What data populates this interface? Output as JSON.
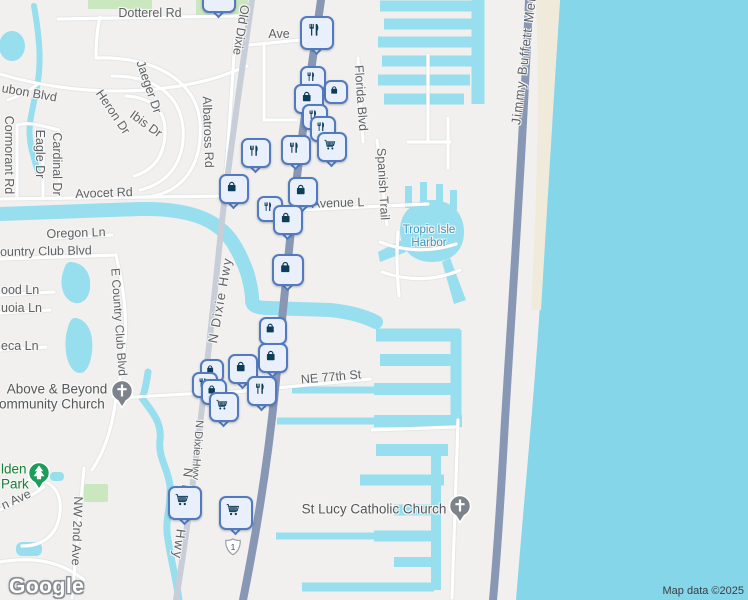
{
  "map": {
    "attribution": {
      "logo": "Google",
      "map_data": "Map data ©2025"
    },
    "route_shield": {
      "number": "1",
      "x": 233,
      "y": 547
    },
    "colors": {
      "land": "#F1F0EE",
      "ocean": "#86D6E9",
      "canal": "#97DEEE",
      "beach": "#F0EADB",
      "park_green": "#CBE7C0",
      "road_major": "#8797B4",
      "road_gray": "#C8CED7",
      "marker_bg": "#EAF0FB",
      "marker_border": "#5379BE",
      "marker_icon": "#0E3D58",
      "poi_church": "#7C838A",
      "poi_park": "#1E9C5A",
      "harbor_text": "#3E97BD",
      "park_text": "#188038"
    },
    "road_labels": [
      {
        "t": "Dotterel Rd",
        "x": 150,
        "y": 13,
        "r": 0
      },
      {
        "t": "Ave",
        "x": 279,
        "y": 34,
        "r": 0
      },
      {
        "t": "Old Dixie",
        "x": 241,
        "y": 30,
        "r": 99
      },
      {
        "t": "Albatross Rd",
        "x": 208,
        "y": 132,
        "r": 88
      },
      {
        "t": "Florida Blvd",
        "x": 361,
        "y": 98,
        "r": 86
      },
      {
        "t": "Jimmy Buffett Mem",
        "x": 524,
        "y": 57,
        "r": -83,
        "fs": 13,
        "ls": 1.5
      },
      {
        "t": "Spanish Trail",
        "x": 383,
        "y": 184,
        "r": 87
      },
      {
        "t": "Cormorant Rd",
        "x": 9,
        "y": 155,
        "r": 90
      },
      {
        "t": "Eagle Dr",
        "x": 40,
        "y": 154,
        "r": 90
      },
      {
        "t": "Cardinal Dr",
        "x": 57,
        "y": 164,
        "r": 90
      },
      {
        "t": "Heron Dr",
        "x": 113,
        "y": 112,
        "r": 56
      },
      {
        "t": "Ibis Dr",
        "x": 146,
        "y": 124,
        "r": 36
      },
      {
        "t": "Jaeger Dr",
        "x": 149,
        "y": 87,
        "r": 71
      },
      {
        "t": "Avocet Rd",
        "x": 104,
        "y": 193,
        "r": -2
      },
      {
        "t": "ubon Blvd",
        "x": 2,
        "y": 88,
        "r": 10,
        "a": "l"
      },
      {
        "t": "Oregon Ln",
        "x": 76,
        "y": 233,
        "r": -2
      },
      {
        "t": "ountry Club Blvd",
        "x": 0,
        "y": 252,
        "r": -1,
        "a": "l"
      },
      {
        "t": "ood Ln",
        "x": 1,
        "y": 290,
        "r": 0,
        "a": "l"
      },
      {
        "t": "uoia Ln",
        "x": 1,
        "y": 308,
        "r": 0,
        "a": "l"
      },
      {
        "t": "eca Ln",
        "x": 1,
        "y": 346,
        "r": 0,
        "a": "l"
      },
      {
        "t": "E Country Club Blvd",
        "x": 119,
        "y": 322,
        "r": 86,
        "fs": 12
      },
      {
        "t": "N Dixie Hwy",
        "x": 220,
        "y": 300,
        "r": -80,
        "fs": 13,
        "ls": 1.5
      },
      {
        "t": "N Dixie Hwy",
        "x": 197,
        "y": 450,
        "r": 94,
        "fs": 11
      },
      {
        "t": "N Dixie Hwy",
        "x": 183,
        "y": 514,
        "r": 97,
        "fs": 13,
        "ls": 2
      },
      {
        "t": "NE 77th St",
        "x": 331,
        "y": 377,
        "r": -5
      },
      {
        "t": "Avenue L",
        "x": 338,
        "y": 203,
        "r": -2
      },
      {
        "t": "NW 2nd Ave",
        "x": 77,
        "y": 531,
        "r": 92
      },
      {
        "t": "n Ave",
        "x": 2,
        "y": 506,
        "r": -25,
        "a": "l"
      }
    ],
    "poi_labels": [
      {
        "t": "Above & Beyond",
        "x": 57,
        "y": 389,
        "r": 0,
        "fs": 13.5,
        "c": "#54585C"
      },
      {
        "t": "Community Church",
        "x": 47,
        "y": 404,
        "r": 0,
        "fs": 13.5,
        "c": "#54585C"
      },
      {
        "t": "St Lucy Catholic Church",
        "x": 374,
        "y": 509,
        "r": 0,
        "fs": 13.5,
        "c": "#54585C"
      },
      {
        "t": "Tropic Isle",
        "x": 429,
        "y": 230,
        "r": 0,
        "fs": 11.5,
        "c": "#3E97BD"
      },
      {
        "t": "Harbor",
        "x": 429,
        "y": 243,
        "r": 0,
        "fs": 11.5,
        "c": "#3E97BD"
      },
      {
        "t": "lden",
        "x": 1,
        "y": 469,
        "r": 0,
        "fs": 13.5,
        "c": "#188038",
        "a": "l"
      },
      {
        "t": "Park",
        "x": 1,
        "y": 484,
        "r": 0,
        "fs": 13.5,
        "c": "#188038",
        "a": "l"
      }
    ],
    "markers": [
      {
        "type": "restaurant",
        "x": 219,
        "y": -4,
        "s": 34,
        "tail": true
      },
      {
        "type": "restaurant",
        "x": 317,
        "y": 33,
        "s": 34,
        "tail": true
      },
      {
        "type": "restaurant",
        "x": 313,
        "y": 79,
        "s": 26,
        "tail": true
      },
      {
        "type": "bag",
        "x": 336,
        "y": 92,
        "s": 24,
        "tail": false
      },
      {
        "type": "bag",
        "x": 309,
        "y": 99,
        "s": 30,
        "tail": true
      },
      {
        "type": "restaurant",
        "x": 315,
        "y": 117,
        "s": 26,
        "tail": false
      },
      {
        "type": "restaurant",
        "x": 323,
        "y": 129,
        "s": 26,
        "tail": false
      },
      {
        "type": "cart",
        "x": 332,
        "y": 147,
        "s": 30,
        "tail": true
      },
      {
        "type": "restaurant",
        "x": 256,
        "y": 153,
        "s": 30,
        "tail": true
      },
      {
        "type": "restaurant",
        "x": 296,
        "y": 150,
        "s": 30,
        "tail": true
      },
      {
        "type": "bag",
        "x": 234,
        "y": 189,
        "s": 30,
        "tail": true
      },
      {
        "type": "bag",
        "x": 303,
        "y": 192,
        "s": 30,
        "tail": true
      },
      {
        "type": "restaurant",
        "x": 270,
        "y": 209,
        "s": 26,
        "tail": false
      },
      {
        "type": "bag",
        "x": 288,
        "y": 220,
        "s": 30,
        "tail": true
      },
      {
        "type": "bag",
        "x": 288,
        "y": 270,
        "s": 32,
        "tail": true
      },
      {
        "type": "bag",
        "x": 273,
        "y": 331,
        "s": 28,
        "tail": false
      },
      {
        "type": "bag",
        "x": 273,
        "y": 358,
        "s": 30,
        "tail": true
      },
      {
        "type": "bag",
        "x": 243,
        "y": 369,
        "s": 30,
        "tail": true
      },
      {
        "type": "bag",
        "x": 212,
        "y": 371,
        "s": 24,
        "tail": false
      },
      {
        "type": "restaurant",
        "x": 205,
        "y": 385,
        "s": 26,
        "tail": false
      },
      {
        "type": "bag",
        "x": 214,
        "y": 392,
        "s": 26,
        "tail": false
      },
      {
        "type": "restaurant",
        "x": 262,
        "y": 391,
        "s": 30,
        "tail": true
      },
      {
        "type": "cart",
        "x": 224,
        "y": 407,
        "s": 30,
        "tail": true
      },
      {
        "type": "cart",
        "x": 185,
        "y": 503,
        "s": 34,
        "tail": true
      },
      {
        "type": "cart",
        "x": 236,
        "y": 513,
        "s": 34,
        "tail": true
      }
    ],
    "pins": [
      {
        "type": "church",
        "x": 122,
        "y": 392
      },
      {
        "type": "park",
        "x": 39,
        "y": 474
      },
      {
        "type": "church",
        "x": 460,
        "y": 507
      }
    ]
  }
}
